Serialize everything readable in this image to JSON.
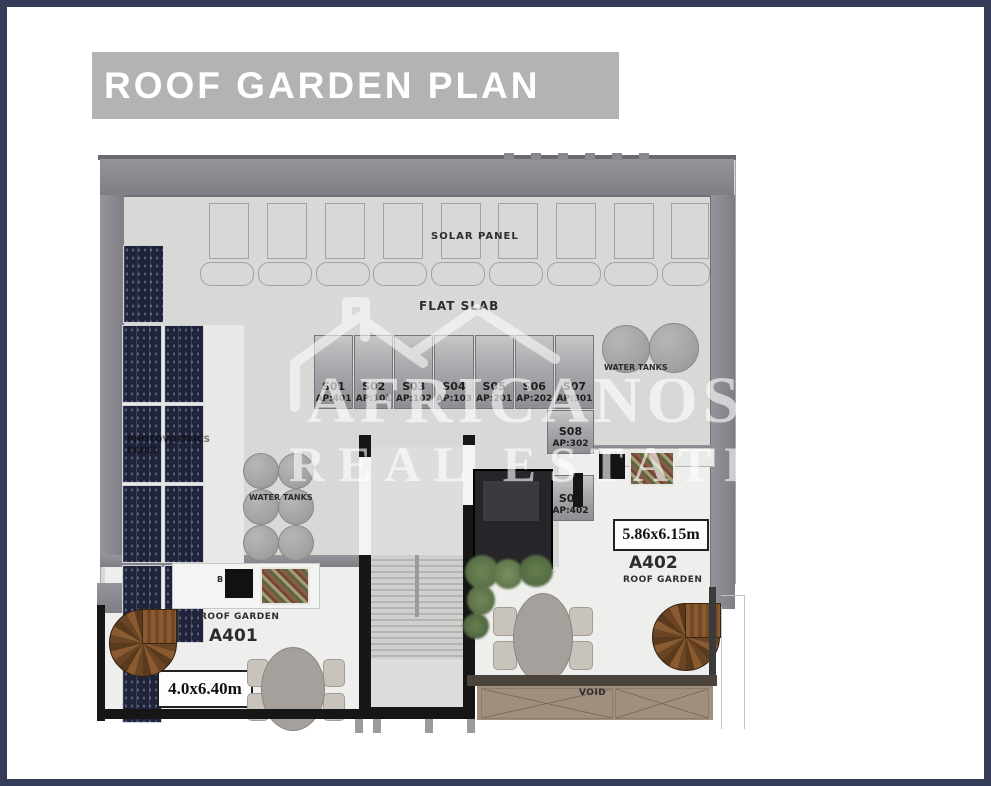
{
  "header": {
    "title": "ROOF GARDEN PLAN",
    "bg_color": "#b5b2b3",
    "text_color": "#ffffff"
  },
  "page": {
    "border_color": "#353c5a",
    "background": "#ffffff"
  },
  "watermark": {
    "line1": "AFRICANOS",
    "line2": "REAL ESTATE"
  },
  "plan": {
    "labels": {
      "solar_panel": "SOLAR PANEL",
      "flat_slab": "FLAT SLAB",
      "photovoltaic": "PHOTOVOLTAICS PANEL",
      "water_tanks_left": "WATER TANKS",
      "water_tanks_right": "WATER TANKS",
      "void": "VOID",
      "bbq": "B"
    },
    "storage_units": [
      {
        "id": "S01",
        "ap": "AP:401"
      },
      {
        "id": "S02",
        "ap": "AP:101"
      },
      {
        "id": "S03",
        "ap": "AP:102"
      },
      {
        "id": "S04",
        "ap": "AP:103"
      },
      {
        "id": "S05",
        "ap": "AP:201"
      },
      {
        "id": "S06",
        "ap": "AP:202"
      },
      {
        "id": "S07",
        "ap": "AP:301"
      },
      {
        "id": "S08",
        "ap": "AP:302"
      },
      {
        "id": "S09",
        "ap": "AP:402"
      }
    ],
    "apartments": [
      {
        "id": "A401",
        "type": "ROOF GARDEN",
        "dimensions": "4.0x6.40m"
      },
      {
        "id": "A402",
        "type": "ROOF GARDEN",
        "dimensions": "5.86x6.15m"
      }
    ]
  }
}
